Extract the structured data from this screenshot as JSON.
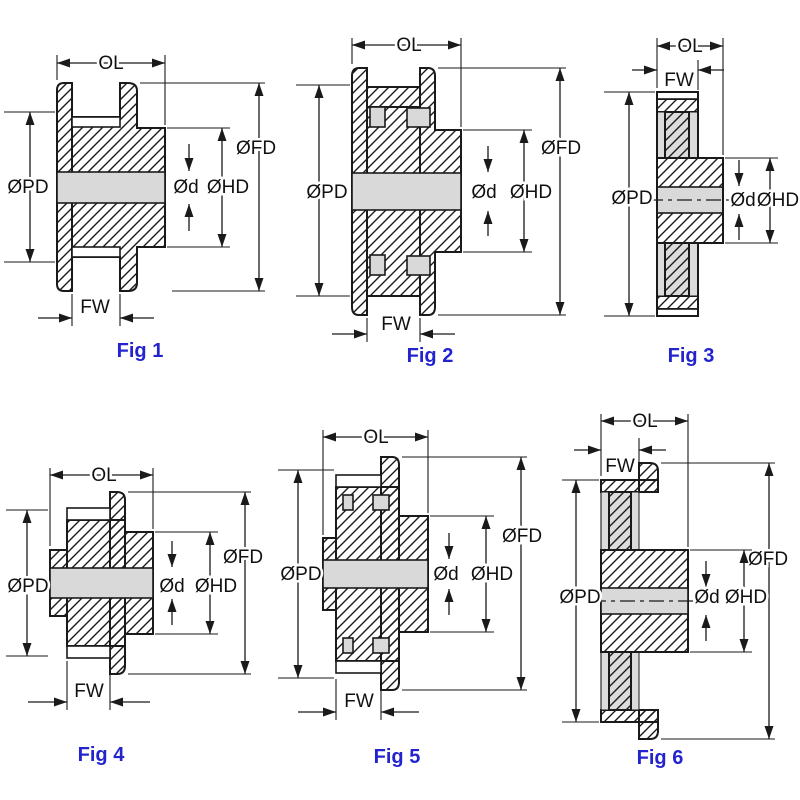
{
  "sheet": {
    "background": "#ffffff",
    "rows": 2,
    "cols": 3
  },
  "dimension_labels": {
    "ol": "OL",
    "fw": "FW",
    "pd": "ØPD",
    "fd": "ØFD",
    "hd": "ØHD",
    "d": "Ød"
  },
  "figures": [
    {
      "caption": "Fig 1",
      "dimensions_shown": [
        "OL",
        "ØPD",
        "ØFD",
        "ØHD",
        "Ød",
        "FW"
      ]
    },
    {
      "caption": "Fig 2",
      "dimensions_shown": [
        "OL",
        "ØPD",
        "ØFD",
        "ØHD",
        "Ød",
        "FW"
      ]
    },
    {
      "caption": "Fig 3",
      "dimensions_shown": [
        "OL",
        "FW",
        "ØPD",
        "ØHD",
        "Ød"
      ]
    },
    {
      "caption": "Fig 4",
      "dimensions_shown": [
        "OL",
        "ØPD",
        "ØFD",
        "ØHD",
        "Ød",
        "FW"
      ]
    },
    {
      "caption": "Fig 5",
      "dimensions_shown": [
        "OL",
        "ØPD",
        "ØFD",
        "ØHD",
        "Ød",
        "FW"
      ]
    },
    {
      "caption": "Fig 6",
      "dimensions_shown": [
        "OL",
        "FW",
        "ØPD",
        "ØFD",
        "ØHD",
        "Ød"
      ]
    }
  ],
  "colors": {
    "line": "#1a1a1a",
    "bore_fill": "#d9d9d9",
    "web_fill": "#dcdcdc",
    "caption": "#2424cf",
    "label_text": "#111111"
  }
}
